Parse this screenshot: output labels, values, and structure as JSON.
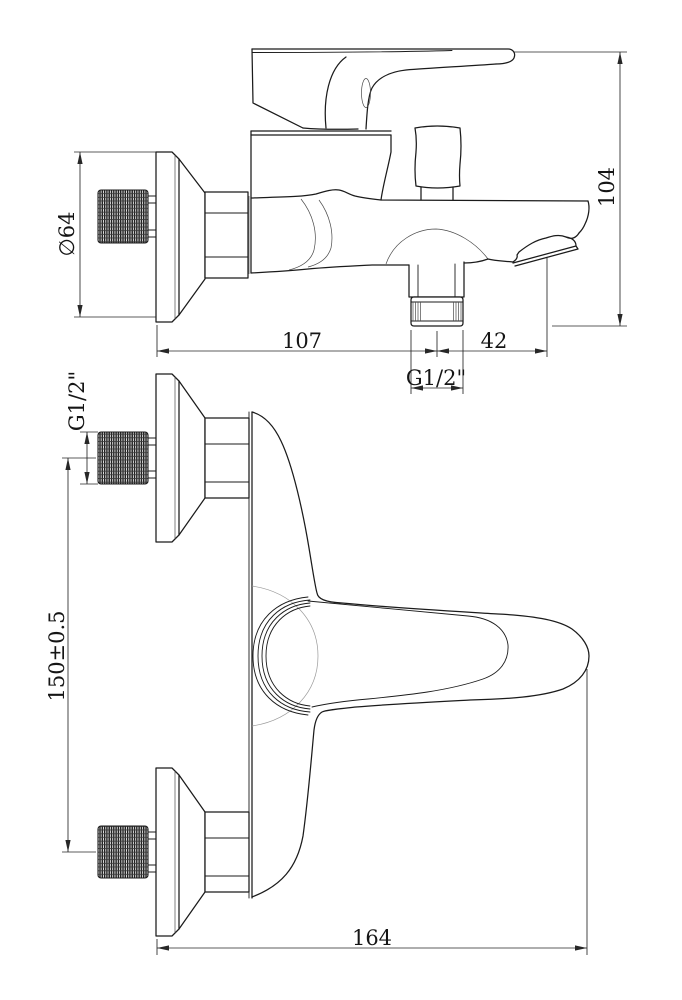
{
  "colors": {
    "background": "#ffffff",
    "line": "#1b1b1b",
    "dimension": "#272727"
  },
  "views": {
    "side": {
      "name": "side-elevation-view",
      "dims": {
        "diameter": "∅64",
        "body_depth": "107",
        "spout_offset": "42",
        "outlet_thread": "G1/2\"",
        "overall_height": "104"
      }
    },
    "plan": {
      "name": "plan-view",
      "dims": {
        "inlet_thread": "G1/2\"",
        "inlet_spacing": "150±0.5",
        "overall_length": "164"
      }
    }
  }
}
